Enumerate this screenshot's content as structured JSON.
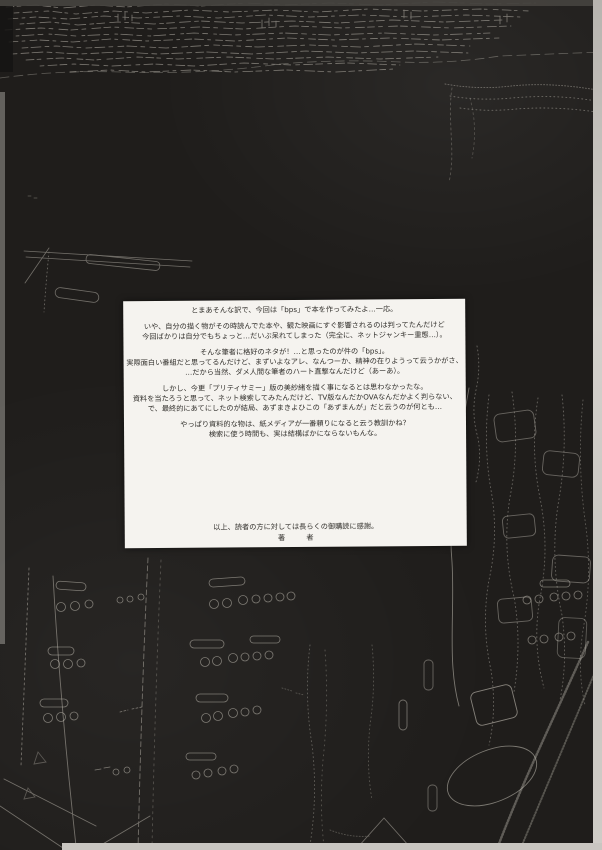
{
  "afterword": {
    "paragraphs": [
      [
        "とまあそんな訳で、今回は「bps」で本を作ってみたよ…一応。"
      ],
      [
        "いや、自分の描く物がその時読んでた本や、観た映画にすぐ影響されるのは判ってたんだけど",
        "今回ばかりは自分でもちょっと…だいぶ呆れてしまった（完全に、ネットジャンキー重態…）。"
      ],
      [
        "そんな筆者に格好のネタが！…と思ったのが件の「bps」。",
        "実際面白い番組だと思ってるんだけど、まずいよなアレ、なんつーか、精神の在りようって云うかがさ、",
        "…だから当然、ダメ人間な筆者のハート直撃なんだけど（あーあ）。"
      ],
      [
        "しかし、今更「プリティサミー」版の美紗緒を描く事になるとは思わなかったな。",
        "資料を当たろうと思って、ネット検索してみたんだけど、TV版なんだかOVAなんだかよく判らない、",
        "で、最終的にあてにしたのが結局、あずまきよひこの「あずまんが」だと云うのが何とも…"
      ],
      [
        "やっぱり資料的な物は、紙メディアが一番頼りになると云う教訓かね？",
        "検索に使う時間も、実は結構ばかにならないもんな。"
      ]
    ],
    "closing": "以上、読者の方に対しては長らくの御購読に感謝。",
    "signature": "著　者"
  },
  "colors": {
    "background": "#1f1d1b",
    "paper": "#f5f3ef",
    "ink": "#32302c",
    "line_art": "#d8d3c8",
    "scan_edge_light": "#c9c6c1",
    "scan_edge_top": "#45423e"
  }
}
